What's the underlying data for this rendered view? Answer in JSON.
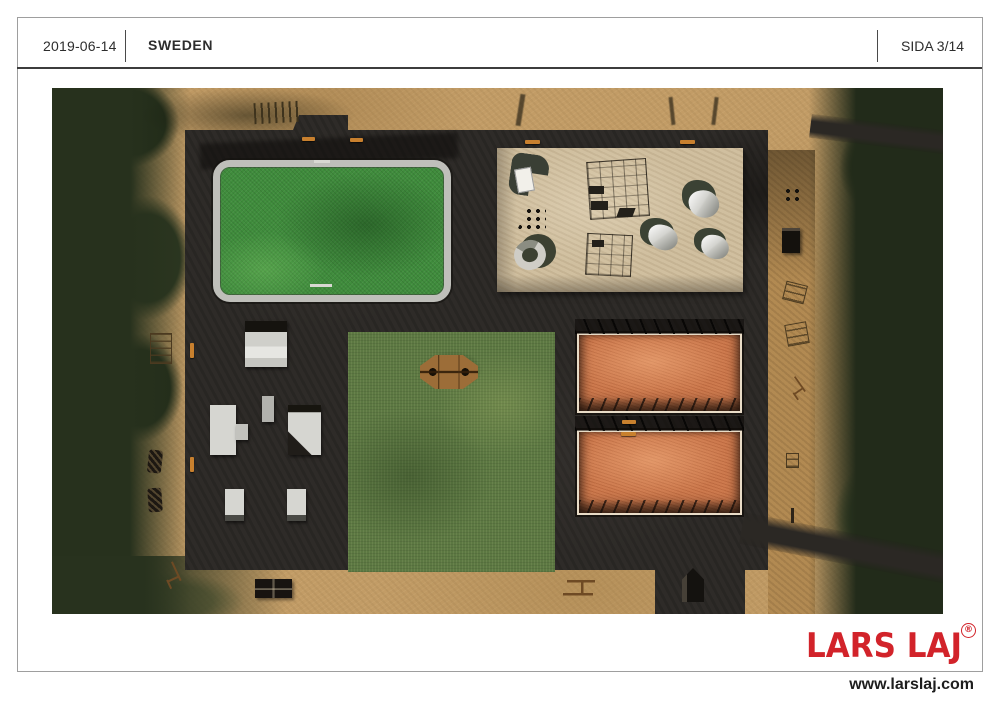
{
  "header": {
    "date": "2019-06-14",
    "country": "SWEDEN",
    "page_indicator": "SIDA 3/14"
  },
  "footer": {
    "brand": "LARS LAJ",
    "registered_mark": "®",
    "website": "www.larslaj.com"
  },
  "plan": {
    "kind": "aerial-playground-site-plan-render",
    "areas": [
      "tree-line-left",
      "tree-line-right",
      "sand-ground",
      "asphalt-surface",
      "mini-pitch-arena",
      "playground-sand-area",
      "lawn-square",
      "wooden-pergola",
      "orange-court-upper",
      "orange-court-lower",
      "skate-zone",
      "fitness-path-right",
      "bottom-equipment-path"
    ]
  },
  "colors": {
    "brand_red": "#d2232a",
    "text_dark": "#2d2d2d",
    "border_gray": "#9e9e9e",
    "sand": "#c29c66",
    "asphalt": "#2e2b28",
    "pitch_green": "#3f8c3c",
    "lawn_green": "#5c7842",
    "court_orange": "#cd7a4e",
    "play_sand": "#d0bf9f",
    "vegetation_dark": "#27311d",
    "fence_gray": "#bfbfba",
    "wood_brown": "#9c6d38"
  }
}
